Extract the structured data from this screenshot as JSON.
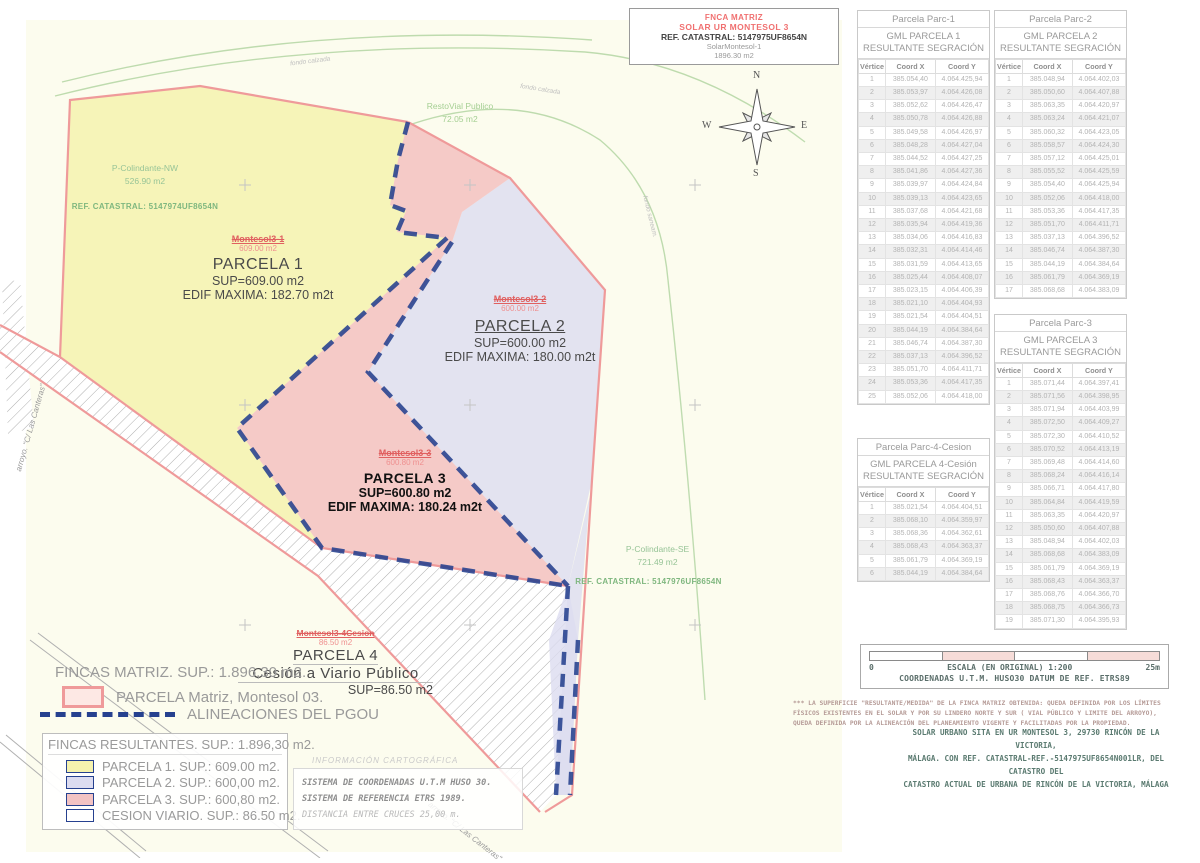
{
  "title_block": {
    "line1": "FNCA MATRIZ",
    "line2": "SOLAR UR MONTESOL 3",
    "line3": "REF. CATASTRAL: 5147975UF8654N",
    "line4": "SolarMontesol-1",
    "line5": "1896.30 m2"
  },
  "compass": {
    "n": "N",
    "e": "E",
    "s": "S",
    "w": "W"
  },
  "map_labels": {
    "colindante_nw": {
      "name": "P-Colindante-NW",
      "area": "526.90 m2",
      "ref": "REF. CATASTRAL: 5147974UF8654N"
    },
    "resto_vial": {
      "name": "RestoVial Publico",
      "area": "72.05 m2"
    },
    "colindante_se": {
      "name": "P-Colindante-SE",
      "area": "721.49 m2",
      "ref": "REF. CATASTRAL: 5147976UF8654N"
    },
    "parcela1": {
      "id": "Montesol3-1",
      "area": "609.00 m2",
      "name": "PARCELA 1",
      "sup": "SUP=609.00 m2",
      "edif": "EDIF MAXIMA: 182.70 m2t"
    },
    "parcela2": {
      "id": "Montesol3-2",
      "area": "600.00 m2",
      "name": "PARCELA 2",
      "sup": "SUP=600.00 m2",
      "edif": "EDIF MAXIMA: 180.00 m2t"
    },
    "parcela3": {
      "id": "Montesol3-3",
      "area": "600.80 m2",
      "name": "PARCELA 3",
      "sup": "SUP=600.80 m2",
      "edif": "EDIF MAXIMA: 180.24 m2t"
    },
    "parcela4": {
      "id": "Montesol3-4Cesion",
      "area": "86.50 m2",
      "name": "PARCELA 4",
      "cesion": "Cesión a Viario Público",
      "sup": "SUP=86.50 m2"
    },
    "street_left": "arroyo. \"C/ Las Canteras\"",
    "street_bottom": "arroyo. \"C/ Las Canteras\"",
    "road_top1": "fondo calzada",
    "road_top2": "fondo calzada",
    "road_right": "fondo saneam."
  },
  "legend": {
    "fincas_matriz": "FINCAS MATRIZ.  SUP.: 1.896,30 m2.",
    "parcela_matriz": "PARCELA Matriz, Montesol 03.",
    "alineaciones": "ALINEACIONES DEL PGOU",
    "resultantes_title": "FINCAS RESULTANTES. SUP.: 1.896,30 m2.",
    "items": [
      {
        "label": "PARCELA 1. SUP.: 609.00 m2.",
        "color": "#f5f2ae"
      },
      {
        "label": "PARCELA 2. SUP.: 600,00 m2.",
        "color": "#dcdcf0"
      },
      {
        "label": "PARCELA 3. SUP.: 600,80 m2.",
        "color": "#f3c3c3"
      },
      {
        "label": "CESION VIARIO. SUP.: 86.50 m2.",
        "color": "#ffffff"
      }
    ]
  },
  "cartografia": {
    "title": "INFORMACIÓN CARTOGRÁFICA",
    "line1": "SISTEMA DE COORDENADAS U.T.M HUSO 30.",
    "line2": "SISTEMA DE REFERENCIA ETRS 1989.",
    "line3": "DISTANCIA ENTRE CRUCES 25,00 m."
  },
  "scale": {
    "zero": "0",
    "max": "25m",
    "label": "ESCALA (EN ORIGINAL) 1:200",
    "coords": "COORDENADAS U.T.M. HUSO30 DATUM DE REF. ETRS89"
  },
  "notes": {
    "small": "*** LA SUPERFICIE \"RESULTANTE/MEDIDA\" DE LA FINCA MATRIZ OBTENIDA: QUEDA DEFINIDA POR LOS LÍMITES FÍSICOS  EXISTENTES EN EL SOLAR Y POR SU LINDERO NORTE Y SUR ( VIAL PÚBLICO Y LIMITE DEL ARROYO), QUEDA DEFINIDA POR  LA ALINEACIÓN DEL PLANEAMIENTO VIGENTE Y FACILITADAS POR LA PROPIEDAD.",
    "main1": "SOLAR URBANO SITA EN UR MONTESOL 3, 29730 RINCÓN DE LA VICTORIA,",
    "main2": "MÁLAGA. CON REF. CATASTRAL-REF.-5147975UF8654N001LR, DEL CATASTRO DEL",
    "main3": "CATASTRO ACTUAL DE URBANA DE RINCÓN DE LA VICTORIA, MÁLAGA"
  },
  "tables": [
    {
      "id": "parc1",
      "title": "Parcela Parc-1",
      "subtitle": "GML PARCELA 1 RESULTANTE SEGRACIÓN",
      "headers": [
        "Vértice",
        "Coord X",
        "Coord Y"
      ],
      "rows": [
        [
          "1",
          "385.054,40",
          "4.064.425,94"
        ],
        [
          "2",
          "385.053,97",
          "4.064.426,08"
        ],
        [
          "3",
          "385.052,62",
          "4.064.426,47"
        ],
        [
          "4",
          "385.050,78",
          "4.064.426,88"
        ],
        [
          "5",
          "385.049,58",
          "4.064.426,97"
        ],
        [
          "6",
          "385.048,28",
          "4.064.427,04"
        ],
        [
          "7",
          "385.044,52",
          "4.064.427,25"
        ],
        [
          "8",
          "385.041,86",
          "4.064.427,36"
        ],
        [
          "9",
          "385.039,97",
          "4.064.424,84"
        ],
        [
          "10",
          "385.039,13",
          "4.064.423,65"
        ],
        [
          "11",
          "385.037,68",
          "4.064.421,68"
        ],
        [
          "12",
          "385.035,94",
          "4.064.419,36"
        ],
        [
          "13",
          "385.034,06",
          "4.064.416,83"
        ],
        [
          "14",
          "385.032,31",
          "4.064.414,46"
        ],
        [
          "15",
          "385.031,59",
          "4.064.413,65"
        ],
        [
          "16",
          "385.025,44",
          "4.064.408,07"
        ],
        [
          "17",
          "385.023,15",
          "4.064.406,39"
        ],
        [
          "18",
          "385.021,10",
          "4.064.404,93"
        ],
        [
          "19",
          "385.021,54",
          "4.064.404,51"
        ],
        [
          "20",
          "385.044,19",
          "4.064.384,64"
        ],
        [
          "21",
          "385.046,74",
          "4.064.387,30"
        ],
        [
          "22",
          "385.037,13",
          "4.064.396,52"
        ],
        [
          "23",
          "385.051,70",
          "4.064.411,71"
        ],
        [
          "24",
          "385.053,36",
          "4.064.417,35"
        ],
        [
          "25",
          "385.052,06",
          "4.064.418,00"
        ]
      ]
    },
    {
      "id": "parc2",
      "title": "Parcela Parc-2",
      "subtitle": "GML PARCELA 2 RESULTANTE SEGRACIÓN",
      "headers": [
        "Vértice",
        "Coord X",
        "Coord Y"
      ],
      "rows": [
        [
          "1",
          "385.048,94",
          "4.064.402,03"
        ],
        [
          "2",
          "385.050,60",
          "4.064.407,88"
        ],
        [
          "3",
          "385.063,35",
          "4.064.420,97"
        ],
        [
          "4",
          "385.063,24",
          "4.064.421,07"
        ],
        [
          "5",
          "385.060,32",
          "4.064.423,05"
        ],
        [
          "6",
          "385.058,57",
          "4.064.424,30"
        ],
        [
          "7",
          "385.057,12",
          "4.064.425,01"
        ],
        [
          "8",
          "385.055,52",
          "4.064.425,59"
        ],
        [
          "9",
          "385.054,40",
          "4.064.425,94"
        ],
        [
          "10",
          "385.052,06",
          "4.064.418,00"
        ],
        [
          "11",
          "385.053,36",
          "4.064.417,35"
        ],
        [
          "12",
          "385.051,70",
          "4.064.411,71"
        ],
        [
          "13",
          "385.037,13",
          "4.064.396,52"
        ],
        [
          "14",
          "385.046,74",
          "4.064.387,30"
        ],
        [
          "15",
          "385.044,19",
          "4.064.384,64"
        ],
        [
          "16",
          "385.061,79",
          "4.064.369,19"
        ],
        [
          "17",
          "385.068,68",
          "4.064.383,09"
        ]
      ]
    },
    {
      "id": "parc3",
      "title": "Parcela Parc-3",
      "subtitle": "GML PARCELA 3 RESULTANTE SEGRACIÓN",
      "headers": [
        "Vértice",
        "Coord X",
        "Coord Y"
      ],
      "rows": [
        [
          "1",
          "385.071,44",
          "4.064.397,41"
        ],
        [
          "2",
          "385.071,56",
          "4.064.398,95"
        ],
        [
          "3",
          "385.071,94",
          "4.064.403,99"
        ],
        [
          "4",
          "385.072,50",
          "4.064.409,27"
        ],
        [
          "5",
          "385.072,30",
          "4.064.410,52"
        ],
        [
          "6",
          "385.070,52",
          "4.064.413,19"
        ],
        [
          "7",
          "385.069,48",
          "4.064.414,60"
        ],
        [
          "8",
          "385.068,24",
          "4.064.416,14"
        ],
        [
          "9",
          "385.066,71",
          "4.064.417,80"
        ],
        [
          "10",
          "385.064,84",
          "4.064.419,59"
        ],
        [
          "11",
          "385.063,35",
          "4.064.420,97"
        ],
        [
          "12",
          "385.050,60",
          "4.064.407,88"
        ],
        [
          "13",
          "385.048,94",
          "4.064.402,03"
        ],
        [
          "14",
          "385.068,68",
          "4.064.383,09"
        ],
        [
          "15",
          "385.061,79",
          "4.064.369,19"
        ],
        [
          "16",
          "385.068,43",
          "4.064.363,37"
        ],
        [
          "17",
          "385.068,76",
          "4.064.366,70"
        ],
        [
          "18",
          "385.068,75",
          "4.064.366,73"
        ],
        [
          "19",
          "385.071,30",
          "4.064.395,93"
        ]
      ]
    },
    {
      "id": "parc4",
      "title": "Parcela Parc-4-Cesion",
      "subtitle": "GML PARCELA  4-Cesión RESULTANTE SEGRACIÓN",
      "headers": [
        "Vértice",
        "Coord X",
        "Coord Y"
      ],
      "rows": [
        [
          "1",
          "385.021,54",
          "4.064.404,51"
        ],
        [
          "2",
          "385.068,10",
          "4.064.359,97"
        ],
        [
          "3",
          "385.068,36",
          "4.064.362,61"
        ],
        [
          "4",
          "385.068,43",
          "4.064.363,37"
        ],
        [
          "5",
          "385.061,79",
          "4.064.369,19"
        ],
        [
          "6",
          "385.044,19",
          "4.064.384,64"
        ]
      ]
    }
  ]
}
